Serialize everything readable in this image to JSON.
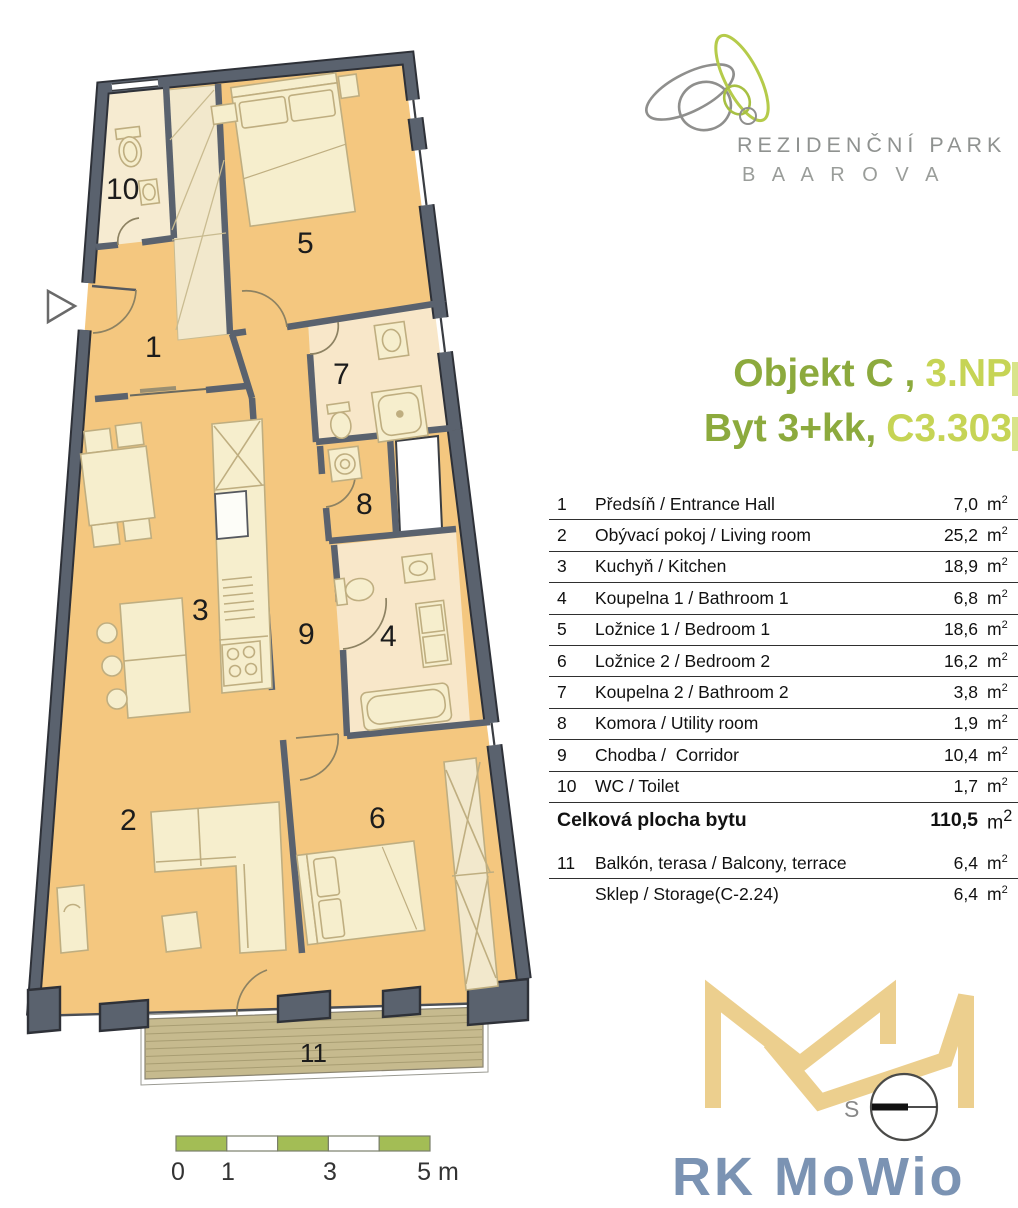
{
  "brand": {
    "name_line1": "REZIDENČNÍ PARK",
    "name_line2": "B A A R O V A"
  },
  "title": {
    "line1_dark": "Objekt C ,",
    "line1_light": "3.NP",
    "line2_dark": "Byt 3+kk,",
    "line2_light": "C3.303"
  },
  "area_table": {
    "unit_base": "m",
    "unit_exp": "2",
    "rows": [
      {
        "num": "1",
        "name": "Předsíň / Entrance Hall",
        "area": "7,0"
      },
      {
        "num": "2",
        "name": "Obývací pokoj / Living room",
        "area": "25,2"
      },
      {
        "num": "3",
        "name": "Kuchyň / Kitchen",
        "area": "18,9"
      },
      {
        "num": "4",
        "name": "Koupelna 1 / Bathroom 1",
        "area": "6,8"
      },
      {
        "num": "5",
        "name": "Ložnice 1 / Bedroom 1",
        "area": "18,6"
      },
      {
        "num": "6",
        "name": "Ložnice 2 / Bedroom 2",
        "area": "16,2"
      },
      {
        "num": "7",
        "name": "Koupelna 2 / Bathroom 2",
        "area": "3,8"
      },
      {
        "num": "8",
        "name": "Komora / Utility room",
        "area": "1,9"
      },
      {
        "num": "9",
        "name": "Chodba /  Corridor",
        "area": "10,4"
      },
      {
        "num": "10",
        "name": "WC / Toilet",
        "area": "1,7"
      }
    ],
    "total": {
      "label": "Celková plocha bytu",
      "area": "110,5"
    },
    "extra_rows": [
      {
        "num": "11",
        "name": "Balkón, terasa / Balcony, terrace",
        "area": "6,4"
      },
      {
        "num": "",
        "name": "Sklep / Storage(C-2.24)",
        "area": "6,4"
      }
    ]
  },
  "plan": {
    "room_labels": [
      {
        "id": "1",
        "label": "1"
      },
      {
        "id": "2",
        "label": "2"
      },
      {
        "id": "3",
        "label": "3"
      },
      {
        "id": "4",
        "label": "4"
      },
      {
        "id": "5",
        "label": "5"
      },
      {
        "id": "6",
        "label": "6"
      },
      {
        "id": "7",
        "label": "7"
      },
      {
        "id": "8",
        "label": "8"
      },
      {
        "id": "9",
        "label": "9"
      },
      {
        "id": "10",
        "label": "10"
      }
    ],
    "balcony_label": "11",
    "scale_bar": {
      "labels": [
        "0",
        "1",
        "3",
        "5 m"
      ]
    },
    "compass_letter": "S"
  },
  "footer_brand": {
    "text": "RK MoWio"
  },
  "colors": {
    "accent_dark_green": "#8caa3d",
    "accent_light_green": "#c6d455",
    "wall": "#5a626e",
    "floor": "#f4c77f",
    "floor_light": "#f8e7c9",
    "furniture": "#f6eecd",
    "balcony_deck": "#c6ba8e",
    "scale_green": "#a3bd55",
    "logo_gold": "#eccf8e",
    "footer_blue": "#7b93b3"
  }
}
